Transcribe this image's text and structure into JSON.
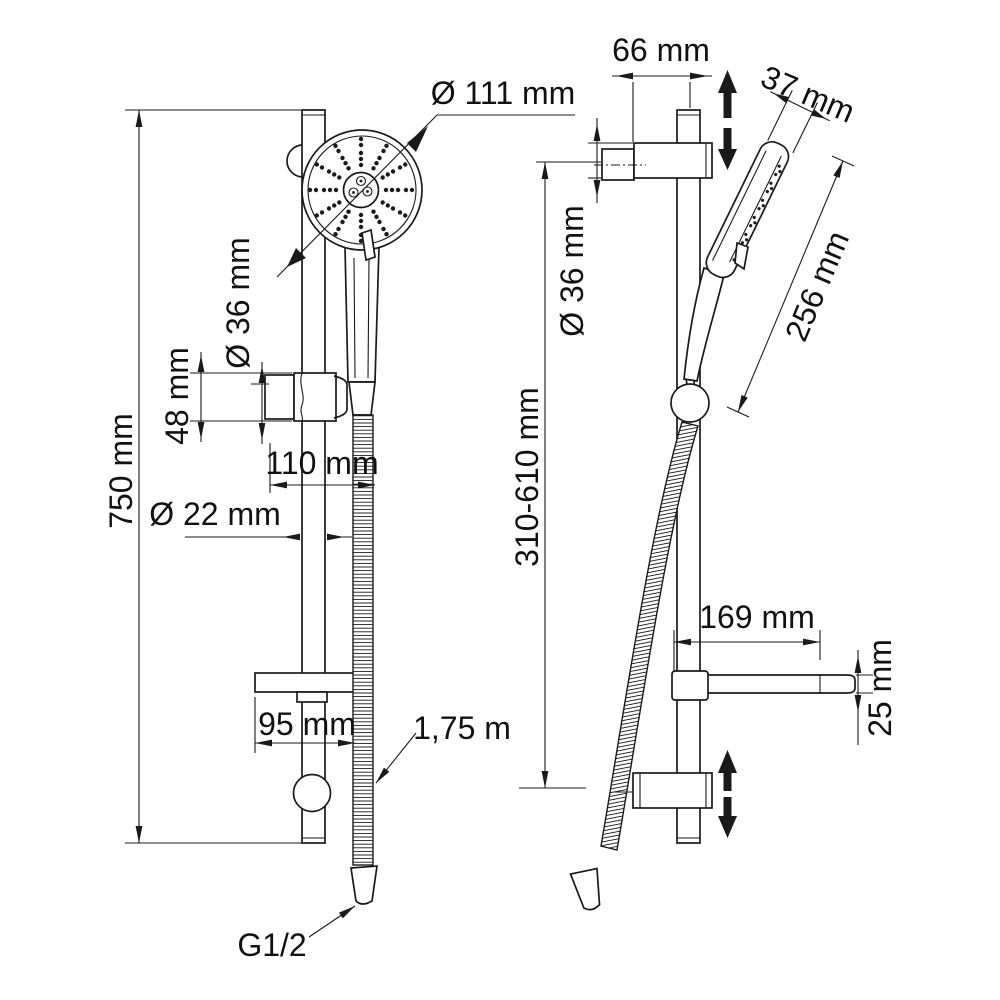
{
  "diagram": {
    "background": "#ffffff",
    "line_color": "#1a1a1a",
    "front_view": {
      "labels": {
        "head_diameter": "Ø 111 mm",
        "holder_clamp_diameter": "Ø 36 mm",
        "holder_height": "48 mm",
        "holder_offset": "110 mm",
        "rail_diameter": "Ø 22 mm",
        "rail_length": "750 mm",
        "shelf_width": "95 mm",
        "hose_length": "1,75 m",
        "thread_size": "G1/2"
      }
    },
    "side_view": {
      "labels": {
        "wall_offset": "66 mm",
        "head_thickness": "37 mm",
        "bracket_height_diameter": "Ø 36 mm",
        "height_adjust_range": "310-610 mm",
        "handshower_length": "256 mm",
        "shelf_depth": "169 mm",
        "shelf_thickness": "25 mm"
      }
    }
  }
}
